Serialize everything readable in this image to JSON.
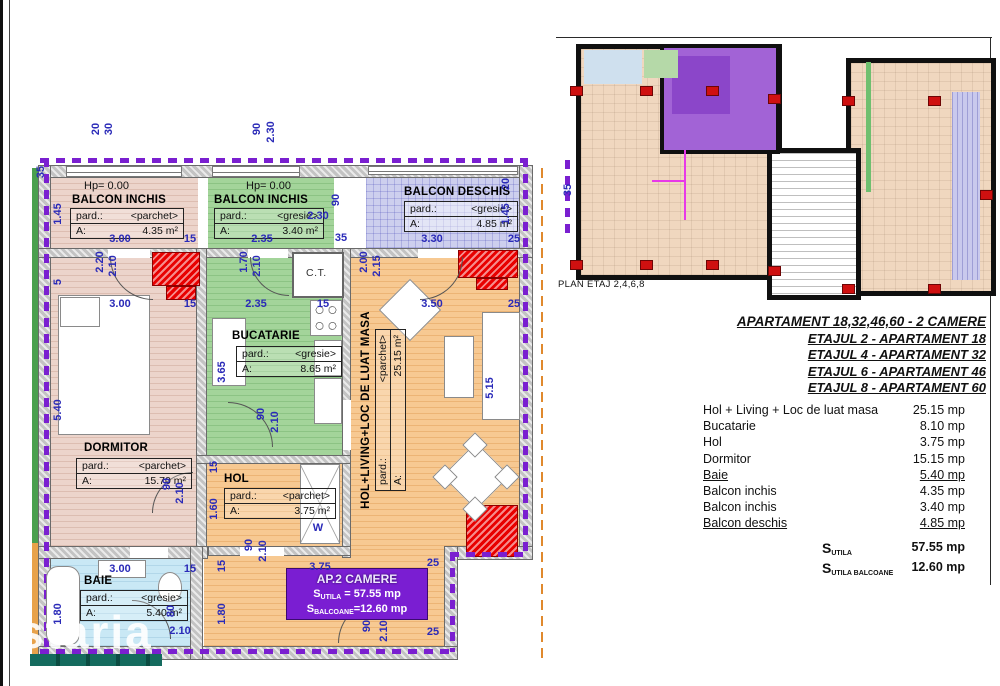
{
  "watermark": "staria",
  "colors": {
    "insulation_purple": "#7a1fd0",
    "pillar_red": "#e80000",
    "dim_blue": "#2a2ab8",
    "highlight_purple": "#a263d6"
  },
  "plan": {
    "rooms": {
      "balcon_inchis_1": {
        "hp": "Hp= 0.00",
        "name": "BALCON INCHIS",
        "floor": "pard.:",
        "floor_value": "<parchet>",
        "area_label": "A:",
        "area": "4.35 m²"
      },
      "balcon_inchis_2": {
        "hp": "Hp= 0.00",
        "name": "BALCON INCHIS",
        "floor": "pard.:",
        "floor_value": "<gresie>",
        "area_label": "A:",
        "area": "3.40 m²"
      },
      "balcon_deschis": {
        "name": "BALCON DESCHIS",
        "floor": "pard.:",
        "floor_value": "<gresie>",
        "area_label": "A:",
        "area": "4.85 m²"
      },
      "dormitor": {
        "name": "DORMITOR",
        "floor": "pard.:",
        "floor_value": "<parchet>",
        "area_label": "A:",
        "area": "15.70 m²"
      },
      "bucatarie": {
        "name": "BUCATARIE",
        "floor": "pard.:",
        "floor_value": "<gresie>",
        "area_label": "A:",
        "area": "8.65 m²"
      },
      "ct": {
        "name": "C.T."
      },
      "living": {
        "name": "HOL+LIVING+LOC DE LUAT MASA",
        "floor": "pard.:",
        "floor_value": "<parchet>",
        "area_label": "A:",
        "area": "25.15 m²"
      },
      "hol": {
        "name": "HOL",
        "floor": "pard.:",
        "floor_value": "<parchet>",
        "area_label": "A:",
        "area": "3.75 m²"
      },
      "baie": {
        "name": "BAIE",
        "floor": "pard.:",
        "floor_value": "<gresie>",
        "area_label": "A:",
        "area": "5.40 m²"
      }
    },
    "badge": {
      "title": "AP.2 CAMERE",
      "s1": "S",
      "s1_sub": "UTILA",
      "s1_rest": "= 57.55 mp",
      "s2": "S",
      "s2_sub": "BALCOANE",
      "s2_rest": "=12.60 mp"
    },
    "dims": [
      {
        "t": "35",
        "x": 41,
        "y": 172,
        "r": 1
      },
      {
        "t": "20",
        "x": 96,
        "y": 129,
        "r": 1
      },
      {
        "t": "30",
        "x": 109,
        "y": 129,
        "r": 1
      },
      {
        "t": "90",
        "x": 257,
        "y": 129,
        "r": 1
      },
      {
        "t": "2.30",
        "x": 271,
        "y": 132,
        "r": 1
      },
      {
        "t": "1.45",
        "x": 58,
        "y": 214,
        "r": 1
      },
      {
        "t": "5",
        "x": 58,
        "y": 282,
        "r": 1
      },
      {
        "t": "3.00",
        "x": 120,
        "y": 239
      },
      {
        "t": "15",
        "x": 190,
        "y": 239
      },
      {
        "t": "2.35",
        "x": 262,
        "y": 239
      },
      {
        "t": "2.30",
        "x": 318,
        "y": 216
      },
      {
        "t": "90",
        "x": 336,
        "y": 200,
        "r": 1
      },
      {
        "t": "35",
        "x": 341,
        "y": 238
      },
      {
        "t": "3.30",
        "x": 432,
        "y": 239
      },
      {
        "t": "25",
        "x": 514,
        "y": 239
      },
      {
        "t": "20",
        "x": 506,
        "y": 184,
        "r": 1
      },
      {
        "t": "1.45",
        "x": 506,
        "y": 214,
        "r": 1
      },
      {
        "t": "35",
        "x": 568,
        "y": 190,
        "r": 1
      },
      {
        "t": "2.20",
        "x": 100,
        "y": 262,
        "r": 1
      },
      {
        "t": "2.10",
        "x": 113,
        "y": 266,
        "r": 1
      },
      {
        "t": "1.70",
        "x": 244,
        "y": 262,
        "r": 1
      },
      {
        "t": "2.10",
        "x": 257,
        "y": 266,
        "r": 1
      },
      {
        "t": "2.00",
        "x": 364,
        "y": 262,
        "r": 1
      },
      {
        "t": "2.15",
        "x": 377,
        "y": 266,
        "r": 1
      },
      {
        "t": "3.00",
        "x": 120,
        "y": 304
      },
      {
        "t": "15",
        "x": 190,
        "y": 304
      },
      {
        "t": "2.35",
        "x": 256,
        "y": 304
      },
      {
        "t": "15",
        "x": 323,
        "y": 304
      },
      {
        "t": "3.50",
        "x": 432,
        "y": 304
      },
      {
        "t": "25",
        "x": 514,
        "y": 304
      },
      {
        "t": "5.40",
        "x": 58,
        "y": 410,
        "r": 1
      },
      {
        "t": "3.65",
        "x": 222,
        "y": 372,
        "r": 1
      },
      {
        "t": "5.15",
        "x": 490,
        "y": 388,
        "r": 1
      },
      {
        "t": "90",
        "x": 261,
        "y": 414,
        "r": 1
      },
      {
        "t": "2.10",
        "x": 275,
        "y": 422,
        "r": 1
      },
      {
        "t": "15",
        "x": 214,
        "y": 467,
        "r": 1
      },
      {
        "t": "1.60",
        "x": 214,
        "y": 509,
        "r": 1
      },
      {
        "t": "90",
        "x": 167,
        "y": 484,
        "r": 1
      },
      {
        "t": "2.10",
        "x": 180,
        "y": 493,
        "r": 1
      },
      {
        "t": "90",
        "x": 249,
        "y": 545,
        "r": 1
      },
      {
        "t": "2.10",
        "x": 263,
        "y": 551,
        "r": 1
      },
      {
        "t": "W",
        "x": 318,
        "y": 528
      },
      {
        "t": "3.75",
        "x": 320,
        "y": 567
      },
      {
        "t": "25",
        "x": 433,
        "y": 563
      },
      {
        "t": "25",
        "x": 433,
        "y": 632
      },
      {
        "t": "3.00",
        "x": 120,
        "y": 569
      },
      {
        "t": "15",
        "x": 190,
        "y": 569
      },
      {
        "t": "15",
        "x": 222,
        "y": 566,
        "r": 1
      },
      {
        "t": "1.80",
        "x": 58,
        "y": 614,
        "r": 1
      },
      {
        "t": "1.80",
        "x": 222,
        "y": 614,
        "r": 1
      },
      {
        "t": "80",
        "x": 171,
        "y": 611,
        "r": 1
      },
      {
        "t": "2.10",
        "x": 180,
        "y": 631
      },
      {
        "t": "90",
        "x": 367,
        "y": 626,
        "r": 1
      },
      {
        "t": "2.10",
        "x": 384,
        "y": 631,
        "r": 1
      }
    ]
  },
  "key_plan": {
    "caption": "PLAN ETAJ 2,4,6,8"
  },
  "info": {
    "headers": [
      "APARTAMENT 18,32,46,60 - 2 CAMERE",
      "ETAJUL 2 - APARTAMENT 18",
      "ETAJUL 4 - APARTAMENT 32",
      "ETAJUL 6 - APARTAMENT 46",
      "ETAJUL 8 - APARTAMENT 60"
    ],
    "rows": [
      {
        "label": "Hol + Living + Loc de luat masa",
        "value": "25.15 mp"
      },
      {
        "label": "Bucatarie",
        "value": "8.10 mp"
      },
      {
        "label": "Hol",
        "value": "3.75 mp"
      },
      {
        "label": "Dormitor",
        "value": "15.15 mp"
      },
      {
        "label": "Baie",
        "value": "5.40 mp",
        "underline": true
      },
      {
        "label": "Balcon inchis",
        "value": "4.35 mp"
      },
      {
        "label": "Balcon inchis",
        "value": "3.40 mp"
      },
      {
        "label": "Balcon deschis",
        "value": "4.85 mp",
        "underline": true
      }
    ],
    "totals": [
      {
        "s": "S",
        "sub": "UTILA",
        "value": "57.55 mp"
      },
      {
        "s": "S",
        "sub": "UTILA BALCOANE",
        "value": "12.60 mp"
      }
    ]
  }
}
